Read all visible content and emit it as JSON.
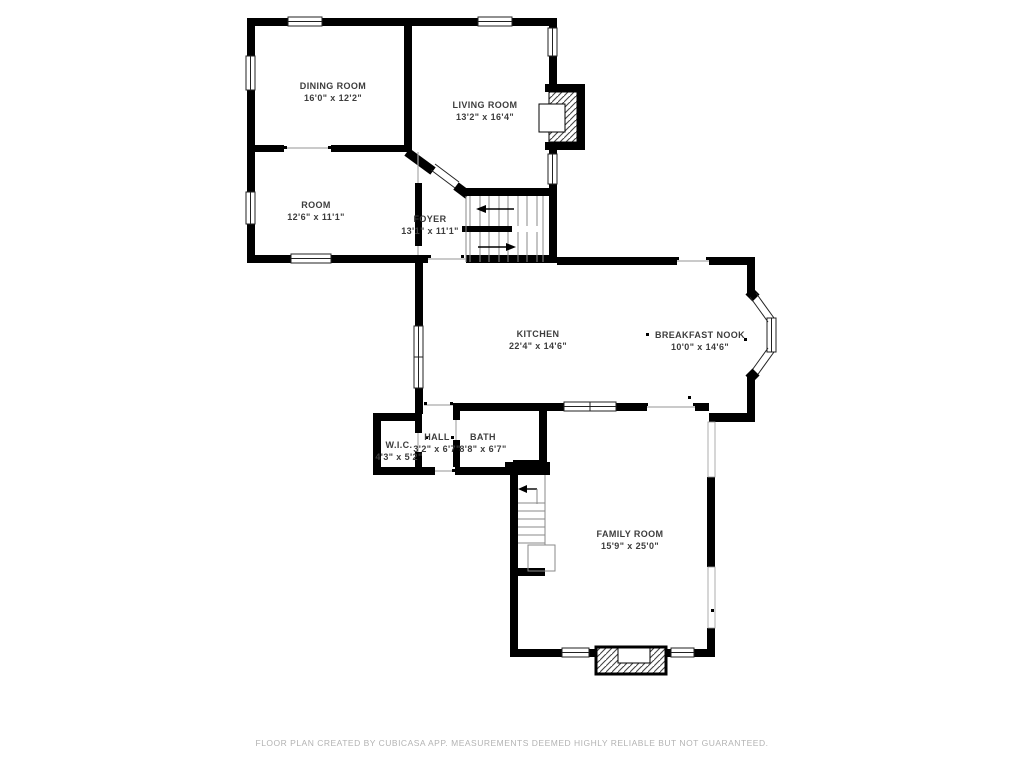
{
  "floor_plan": {
    "rooms": [
      {
        "name": "DINING ROOM",
        "dimensions": "16'0\" x 12'2\""
      },
      {
        "name": "LIVING ROOM",
        "dimensions": "13'2\" x 16'4\""
      },
      {
        "name": "ROOM",
        "dimensions": "12'6\" x 11'1\""
      },
      {
        "name": "FOYER",
        "dimensions": "13'1\" x 11'1\""
      },
      {
        "name": "KITCHEN",
        "dimensions": "22'4\" x 14'6\""
      },
      {
        "name": "BREAKFAST NOOK",
        "dimensions": "10'0\" x 14'6\""
      },
      {
        "name": "W.I.C.",
        "dimensions": "4'3\" x 5'2\""
      },
      {
        "name": "HALL",
        "dimensions": "3'2\" x 6'7\""
      },
      {
        "name": "BATH",
        "dimensions": "8'8\" x 6'7\""
      },
      {
        "name": "FAMILY ROOM",
        "dimensions": "15'9\" x 25'0\""
      }
    ],
    "footer_text": "FLOOR PLAN CREATED BY CUBICASA APP. MEASUREMENTS DEEMED HIGHLY RELIABLE BUT NOT GUARANTEED.",
    "colors": {
      "wall": "#000000",
      "label_text": "#3d3d3d",
      "footer_text": "#b3b3b3",
      "background": "#ffffff"
    }
  }
}
